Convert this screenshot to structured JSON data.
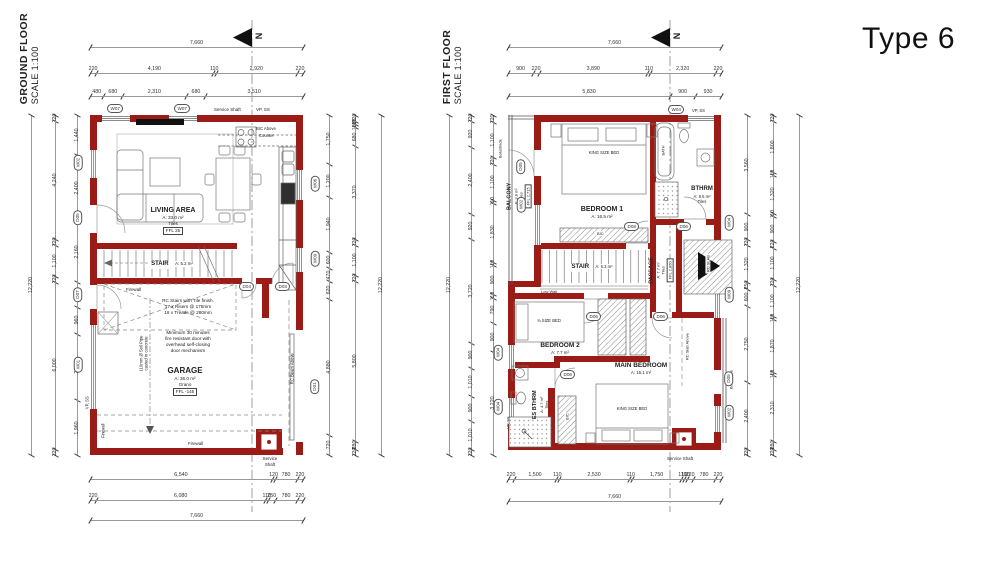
{
  "sheet": {
    "type_label": "Type 6",
    "north_letter": "N"
  },
  "gf": {
    "title": "GROUND FLOOR",
    "scale": "SCALE 1:100",
    "living": {
      "name": "LIVING AREA",
      "area": "A: 33.0 m²",
      "finish": "Tiles",
      "ffl": "FFL 25"
    },
    "stair": {
      "name": "STAIR",
      "area": "A: 5.2 m²"
    },
    "garage": {
      "name": "GARAGE",
      "area": "A: 36.0 m²",
      "finish": "Grano",
      "ffl": "FFL -145"
    },
    "labels": {
      "firewall_stair": "Firewall",
      "firewall_left": "Firewall",
      "firewall_bottom": "Firewall",
      "vp_ss_left": "VP, SS",
      "vp_ss_top": "VP, SS",
      "service_shaft_top": "Service Shaft",
      "service_shaft_b1": "Service",
      "service_shaft_b2": "Shaft",
      "rc_beam": "RC Beam Above",
      "bic_above_1": "BIC Above",
      "bic_above_2": "Counter",
      "soil_1": "110mm Ø Soil Pipe",
      "soil_2": "casted in concrete",
      "stair_note_1": "RC Stairs with Tile finish.",
      "stair_note_2": "17 x Risers @ 175mm",
      "stair_note_3": "16 x Treads @ 280mm",
      "door_note_1": "Minimum 30 minutes",
      "door_note_2": "fire resistant door with",
      "door_note_3": "overhead self-closing",
      "door_note_4": "door mechanism"
    },
    "pills": {
      "w07a": "W07",
      "w07b": "W07",
      "w02": "W02",
      "d05": "D05",
      "d07": "D07",
      "w01": "W01",
      "w06": "W06",
      "w09": "W09",
      "d01": "D01",
      "d04": "D04",
      "d03": "D03"
    },
    "dims": {
      "top1": [
        "7,660"
      ],
      "top2": [
        "220",
        "4,190",
        "110",
        "2,920",
        "220"
      ],
      "top3": [
        "480",
        "680",
        "2,310",
        "680",
        "3,510"
      ],
      "left_outer": [
        "12,220"
      ],
      "left_mid": [
        "220",
        "4,240",
        "220",
        "1,100",
        "220",
        "6,000",
        "220"
      ],
      "left_inner": [
        "1,440",
        "2,400",
        "2,160",
        "900",
        "960",
        "2,400",
        "1,960"
      ],
      "right_inner": [
        "1,750",
        "1,200",
        "1,940",
        "600",
        "470",
        "620",
        "4,880",
        "720"
      ],
      "right_mid": [
        "220",
        "110",
        "110",
        "680",
        "3,370",
        "220",
        "1,100",
        "220",
        "5,800",
        "280",
        "220"
      ],
      "right_outer": [
        "12,220"
      ],
      "bottom1": [
        "6,540",
        "120",
        "780",
        "220"
      ],
      "bottom2": [
        "220",
        "6,080",
        "110",
        "250",
        "780",
        "220"
      ],
      "bottom3": [
        "7,660"
      ]
    }
  },
  "ff": {
    "title": "FIRST FLOOR",
    "scale": "SCALE 1:100",
    "balcony": {
      "name": "BALCONY",
      "area": "A: 3.8 m²",
      "finish": "Tiles",
      "ffl": "FFL 2,715",
      "balustrade": "Balustrade"
    },
    "bed1": {
      "name": "BEDROOM 1",
      "area": "A: 16.5 m²",
      "bed": "KING SIZE BED",
      "bic": "BIC"
    },
    "bthrm": {
      "name": "BTHRM",
      "area": "A: 8.5 m²",
      "finish": "Tiles",
      "bath": "BATH"
    },
    "stair": {
      "name": "STAIR",
      "area": "A: 5.3 m²",
      "low_wall": "Low Wall"
    },
    "passage": {
      "name": "PASSAGE",
      "area": "A: 7.7 m²",
      "finish": "Tiles",
      "ffl": "FFL 2,860"
    },
    "bed2": {
      "name": "BEDROOM 2",
      "area": "A: 7.7 m²",
      "bed": "¾ SIZE BED"
    },
    "main": {
      "name": "MAIN BEDROOM",
      "area": "A: 15.1 m²",
      "bed": "KING SIZE BED",
      "bic": "BIC"
    },
    "esbthrm": {
      "name": "ES BTHRM",
      "area": "A: 4.7 m²",
      "finish": "Tiles"
    },
    "labels": {
      "rc_slab": "RC SLAB",
      "rc_slab_above": "RC Slab Above",
      "balustrade_right": "Balustrade",
      "vp_ss_left": "VP, SS",
      "vp_ss_top": "VP, SS",
      "service_shaft": "Service Shaft"
    },
    "pills": {
      "w04top": "W04",
      "d05bal": "D05",
      "w02bal": "W02",
      "w04a": "W04",
      "w04b": "W04",
      "w04r": "W04",
      "w09": "W09",
      "d05r": "D05",
      "w02r": "W02",
      "d08": "D08",
      "d06a": "D06",
      "d06b": "D06",
      "d06c": "D06",
      "d06d": "D06"
    },
    "dims": {
      "top1": [
        "7,660"
      ],
      "top2": [
        "900",
        "220",
        "3,890",
        "110",
        "2,320",
        "220"
      ],
      "top3": [
        "5,830",
        "900",
        "930"
      ],
      "left_outer": [
        "12,220"
      ],
      "left_mid": [
        "220",
        "920",
        "2,400",
        "920",
        "3,720",
        "900",
        "1,010",
        "900",
        "1,010",
        "220"
      ],
      "left_inner": [
        "220",
        "1,100",
        "220",
        "1,100",
        "110",
        "1,830",
        "110",
        "900",
        "110",
        "790",
        "900",
        "3,220"
      ],
      "right_inner": [
        "3,560",
        "900",
        "220",
        "1,320",
        "250",
        "600",
        "2,750",
        "2,400",
        "220"
      ],
      "right_mid": [
        "220",
        "1,800",
        "110",
        "1,320",
        "110",
        "900",
        "220",
        "1,100",
        "220",
        "1,100",
        "110",
        "1,870",
        "110",
        "2,310",
        "280",
        "220"
      ],
      "right_outer": [
        "12,220"
      ],
      "bottom1": [
        "220",
        "1,500",
        "110",
        "2,530",
        "110",
        "1,750",
        "110",
        "110",
        "220",
        "780",
        "220"
      ],
      "bottom2": [
        "7,660"
      ]
    }
  }
}
